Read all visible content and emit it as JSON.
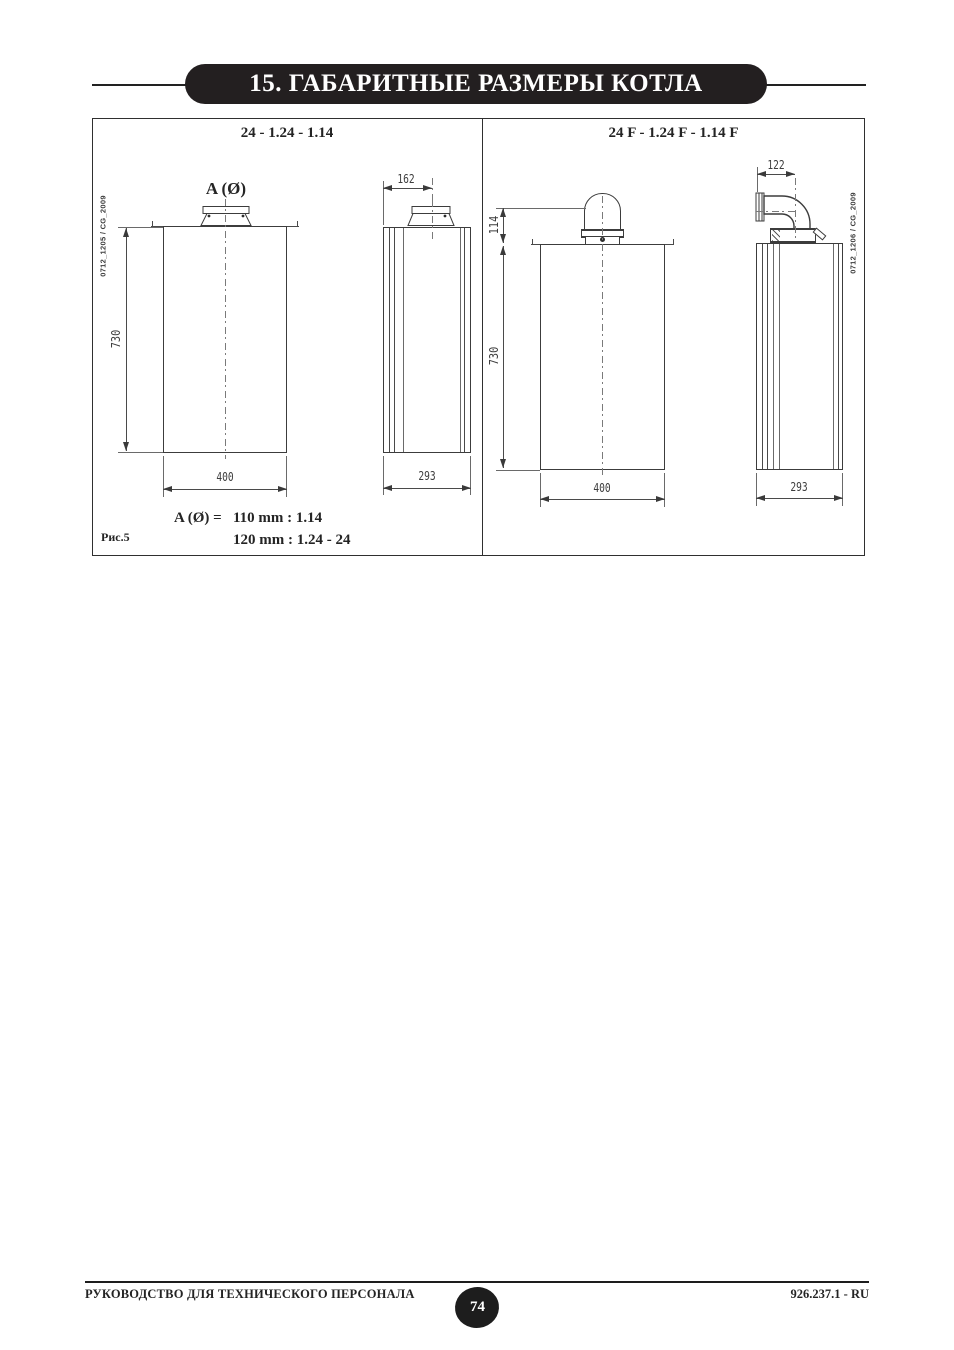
{
  "page": {
    "title": "15. ГАБАРИТНЫЕ РАЗМЕРЫ КОТЛА",
    "figure_label": "Рис.5",
    "page_number": "74",
    "footer_left": "РУКОВОДСТВО ДЛЯ ТЕХНИЧЕСКОГО ПЕРСОНАЛА",
    "footer_right": "926.237.1 - RU"
  },
  "figure": {
    "left_panel": {
      "header": "24 - 1.24 - 1.14",
      "code": "0712_1205 / CG_2009",
      "flue_label": "A (Ø)",
      "front": {
        "height": "730",
        "width": "400"
      },
      "side": {
        "top": "162",
        "depth": "293"
      }
    },
    "right_panel": {
      "header": "24 F - 1.24 F - 1.14 F",
      "code": "0712_1206 / CG_2009",
      "front": {
        "flue_offset": "114",
        "height": "730",
        "width": "400"
      },
      "side": {
        "top": "122",
        "depth": "293"
      }
    },
    "legend": {
      "label": "A (Ø) =",
      "line1": "110 mm : 1.14",
      "line2": "120 mm : 1.24 - 24"
    }
  }
}
